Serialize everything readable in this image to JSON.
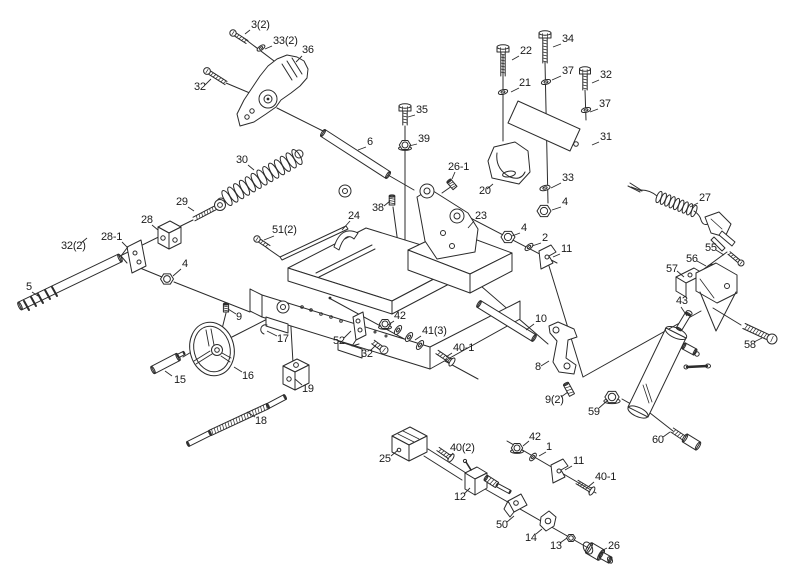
{
  "figure": {
    "type": "exploded-parts-diagram",
    "description": "Exploded assembly drawing of a machine (saw bed, handwheel, feed screw, hydraulic cylinder, switch and power cord) with numbered part callouts",
    "background": "#ffffff",
    "line_color": "#2b2b2b",
    "label_color": "#1a1a1a",
    "label_font_size": 11
  },
  "parts": [
    {
      "id": "3-2",
      "label": "3(2)",
      "x": 251,
      "y": 28,
      "leader": [
        [
          250,
          30
        ],
        [
          245,
          34
        ]
      ]
    },
    {
      "id": "33-2",
      "label": "33(2)",
      "x": 273,
      "y": 44,
      "leader": [
        [
          272,
          46
        ],
        [
          265,
          49
        ]
      ]
    },
    {
      "id": "36",
      "label": "36",
      "x": 302,
      "y": 53,
      "leader": [
        [
          302,
          56
        ],
        [
          296,
          62
        ]
      ]
    },
    {
      "id": "32-tl",
      "label": "32",
      "x": 194,
      "y": 90,
      "leader": [
        [
          205,
          85
        ],
        [
          211,
          79
        ]
      ]
    },
    {
      "id": "30",
      "label": "30",
      "x": 236,
      "y": 163,
      "leader": [
        [
          248,
          165
        ],
        [
          254,
          170
        ]
      ]
    },
    {
      "id": "29",
      "label": "29",
      "x": 176,
      "y": 205,
      "leader": [
        [
          188,
          207
        ],
        [
          194,
          211
        ]
      ]
    },
    {
      "id": "28",
      "label": "28",
      "x": 141,
      "y": 223,
      "leader": [
        [
          152,
          225
        ],
        [
          158,
          230
        ]
      ]
    },
    {
      "id": "28-1",
      "label": "28-1",
      "x": 101,
      "y": 240,
      "leader": [
        [
          122,
          242
        ],
        [
          128,
          248
        ]
      ]
    },
    {
      "id": "32-2",
      "label": "32(2)",
      "x": 61,
      "y": 249,
      "leader": [
        [
          81,
          243
        ],
        [
          87,
          238
        ]
      ]
    },
    {
      "id": "5",
      "label": "5",
      "x": 26,
      "y": 290,
      "leader": [
        [
          32,
          292
        ],
        [
          38,
          296
        ]
      ]
    },
    {
      "id": "4-left",
      "label": "4",
      "x": 182,
      "y": 267,
      "leader": [
        [
          181,
          269
        ],
        [
          173,
          276
        ]
      ]
    },
    {
      "id": "6",
      "label": "6",
      "x": 367,
      "y": 145,
      "leader": [
        [
          366,
          147
        ],
        [
          358,
          150
        ]
      ]
    },
    {
      "id": "35",
      "label": "35",
      "x": 416,
      "y": 113,
      "leader": [
        [
          415,
          115
        ],
        [
          408,
          117
        ]
      ]
    },
    {
      "id": "39",
      "label": "39",
      "x": 418,
      "y": 142,
      "leader": [
        [
          417,
          144
        ],
        [
          409,
          146
        ]
      ]
    },
    {
      "id": "26-1",
      "label": "26-1",
      "x": 448,
      "y": 170,
      "leader": [
        [
          455,
          172
        ],
        [
          452,
          179
        ]
      ]
    },
    {
      "id": "38",
      "label": "38",
      "x": 372,
      "y": 211,
      "leader": [
        [
          384,
          206
        ],
        [
          390,
          201
        ]
      ]
    },
    {
      "id": "24",
      "label": "24",
      "x": 348,
      "y": 219,
      "leader": [
        [
          350,
          221
        ],
        [
          342,
          230
        ]
      ]
    },
    {
      "id": "51-2",
      "label": "51(2)",
      "x": 272,
      "y": 233,
      "leader": [
        [
          274,
          236
        ],
        [
          264,
          240
        ]
      ]
    },
    {
      "id": "23",
      "label": "23",
      "x": 475,
      "y": 219,
      "leader": [
        [
          474,
          221
        ],
        [
          468,
          228
        ]
      ]
    },
    {
      "id": "22",
      "label": "22",
      "x": 520,
      "y": 54,
      "leader": [
        [
          519,
          56
        ],
        [
          512,
          60
        ]
      ]
    },
    {
      "id": "34",
      "label": "34",
      "x": 562,
      "y": 42,
      "leader": [
        [
          561,
          44
        ],
        [
          553,
          47
        ]
      ]
    },
    {
      "id": "21",
      "label": "21",
      "x": 519,
      "y": 86,
      "leader": [
        [
          519,
          88
        ],
        [
          511,
          92
        ]
      ]
    },
    {
      "id": "37-a",
      "label": "37",
      "x": 562,
      "y": 74,
      "leader": [
        [
          561,
          76
        ],
        [
          552,
          80
        ]
      ]
    },
    {
      "id": "32-r",
      "label": "32",
      "x": 600,
      "y": 78,
      "leader": [
        [
          599,
          80
        ],
        [
          592,
          83
        ]
      ]
    },
    {
      "id": "37-b",
      "label": "37",
      "x": 599,
      "y": 107,
      "leader": [
        [
          598,
          109
        ],
        [
          590,
          112
        ]
      ]
    },
    {
      "id": "31",
      "label": "31",
      "x": 600,
      "y": 140,
      "leader": [
        [
          599,
          142
        ],
        [
          592,
          145
        ]
      ]
    },
    {
      "id": "20",
      "label": "20",
      "x": 479,
      "y": 194,
      "leader": [
        [
          487,
          189
        ],
        [
          493,
          184
        ]
      ]
    },
    {
      "id": "33",
      "label": "33",
      "x": 562,
      "y": 181,
      "leader": [
        [
          561,
          183
        ],
        [
          551,
          188
        ]
      ]
    },
    {
      "id": "4-a",
      "label": "4",
      "x": 562,
      "y": 205,
      "leader": [
        [
          561,
          207
        ],
        [
          552,
          210
        ]
      ]
    },
    {
      "id": "4-b",
      "label": "4",
      "x": 521,
      "y": 231,
      "leader": [
        [
          520,
          233
        ],
        [
          512,
          236
        ]
      ]
    },
    {
      "id": "2",
      "label": "2",
      "x": 542,
      "y": 241,
      "leader": [
        [
          541,
          243
        ],
        [
          532,
          246
        ]
      ]
    },
    {
      "id": "11-mid",
      "label": "11",
      "x": 561,
      "y": 252,
      "leader": [
        [
          560,
          254
        ],
        [
          553,
          257
        ]
      ]
    },
    {
      "id": "27",
      "label": "27",
      "x": 699,
      "y": 201,
      "leader": [
        [
          698,
          203
        ],
        [
          690,
          207
        ]
      ]
    },
    {
      "id": "55",
      "label": "55",
      "x": 705,
      "y": 251,
      "leader": [
        [
          716,
          250
        ],
        [
          724,
          255
        ]
      ]
    },
    {
      "id": "56",
      "label": "56",
      "x": 686,
      "y": 262,
      "leader": [
        [
          697,
          261
        ],
        [
          706,
          266
        ]
      ]
    },
    {
      "id": "57",
      "label": "57",
      "x": 666,
      "y": 272,
      "leader": [
        [
          677,
          271
        ],
        [
          684,
          277
        ]
      ]
    },
    {
      "id": "43",
      "label": "43",
      "x": 676,
      "y": 304,
      "leader": [
        [
          681,
          307
        ],
        [
          687,
          316
        ]
      ]
    },
    {
      "id": "58",
      "label": "58",
      "x": 744,
      "y": 348,
      "leader": [
        [
          754,
          342
        ],
        [
          762,
          338
        ]
      ]
    },
    {
      "id": "59",
      "label": "59",
      "x": 588,
      "y": 415,
      "leader": [
        [
          599,
          408
        ],
        [
          608,
          400
        ]
      ]
    },
    {
      "id": "60",
      "label": "60",
      "x": 652,
      "y": 443,
      "leader": [
        [
          663,
          437
        ],
        [
          670,
          432
        ]
      ]
    },
    {
      "id": "9",
      "label": "9",
      "x": 236,
      "y": 320,
      "leader": [
        [
          236,
          314
        ],
        [
          228,
          309
        ]
      ]
    },
    {
      "id": "17",
      "label": "17",
      "x": 277,
      "y": 342,
      "leader": [
        [
          277,
          336
        ],
        [
          267,
          331
        ]
      ]
    },
    {
      "id": "16",
      "label": "16",
      "x": 242,
      "y": 379,
      "leader": [
        [
          242,
          372
        ],
        [
          234,
          367
        ]
      ]
    },
    {
      "id": "15",
      "label": "15",
      "x": 174,
      "y": 383,
      "leader": [
        [
          172,
          376
        ],
        [
          165,
          371
        ]
      ]
    },
    {
      "id": "19",
      "label": "19",
      "x": 302,
      "y": 392,
      "leader": [
        [
          302,
          385
        ],
        [
          295,
          379
        ]
      ]
    },
    {
      "id": "18",
      "label": "18",
      "x": 255,
      "y": 424,
      "leader": [
        [
          255,
          417
        ],
        [
          247,
          412
        ]
      ]
    },
    {
      "id": "25",
      "label": "25",
      "x": 379,
      "y": 462,
      "leader": [
        [
          391,
          456
        ],
        [
          398,
          450
        ]
      ]
    },
    {
      "id": "52",
      "label": "52",
      "x": 333,
      "y": 344,
      "leader": [
        [
          344,
          338
        ],
        [
          351,
          331
        ]
      ]
    },
    {
      "id": "32-b",
      "label": "32",
      "x": 361,
      "y": 357,
      "leader": [
        [
          371,
          350
        ],
        [
          376,
          345
        ]
      ]
    },
    {
      "id": "42-top",
      "label": "42",
      "x": 394,
      "y": 319,
      "leader": [
        [
          394,
          321
        ],
        [
          388,
          325
        ]
      ]
    },
    {
      "id": "41-3",
      "label": "41(3)",
      "x": 422,
      "y": 334,
      "leader": [
        [
          421,
          336
        ],
        [
          415,
          340
        ]
      ]
    },
    {
      "id": "40-1-a",
      "label": "40-1",
      "x": 453,
      "y": 351,
      "leader": [
        [
          452,
          353
        ],
        [
          446,
          357
        ]
      ]
    },
    {
      "id": "10",
      "label": "10",
      "x": 535,
      "y": 322,
      "leader": [
        [
          534,
          324
        ],
        [
          526,
          330
        ]
      ]
    },
    {
      "id": "8",
      "label": "8",
      "x": 535,
      "y": 370,
      "leader": [
        [
          541,
          366
        ],
        [
          549,
          361
        ]
      ]
    },
    {
      "id": "9-2",
      "label": "9(2)",
      "x": 545,
      "y": 403,
      "leader": [
        [
          561,
          397
        ],
        [
          568,
          392
        ]
      ]
    },
    {
      "id": "40-2",
      "label": "40(2)",
      "x": 450,
      "y": 451,
      "leader": [
        [
          453,
          453
        ],
        [
          450,
          457
        ]
      ]
    },
    {
      "id": "42-bot",
      "label": "42",
      "x": 529,
      "y": 440,
      "leader": [
        [
          529,
          441
        ],
        [
          523,
          446
        ]
      ]
    },
    {
      "id": "1",
      "label": "1",
      "x": 546,
      "y": 450,
      "leader": [
        [
          546,
          452
        ],
        [
          539,
          456
        ]
      ]
    },
    {
      "id": "11-bot",
      "label": "11",
      "x": 573,
      "y": 464,
      "leader": [
        [
          572,
          466
        ],
        [
          565,
          470
        ]
      ]
    },
    {
      "id": "40-1-b",
      "label": "40-1",
      "x": 595,
      "y": 480,
      "leader": [
        [
          594,
          482
        ],
        [
          588,
          487
        ]
      ]
    },
    {
      "id": "12",
      "label": "12",
      "x": 454,
      "y": 500,
      "leader": [
        [
          464,
          494
        ],
        [
          470,
          488
        ]
      ]
    },
    {
      "id": "50",
      "label": "50",
      "x": 496,
      "y": 528,
      "leader": [
        [
          507,
          522
        ],
        [
          514,
          516
        ]
      ]
    },
    {
      "id": "14",
      "label": "14",
      "x": 525,
      "y": 541,
      "leader": [
        [
          536,
          534
        ],
        [
          542,
          529
        ]
      ]
    },
    {
      "id": "13",
      "label": "13",
      "x": 550,
      "y": 549,
      "leader": [
        [
          560,
          543
        ],
        [
          567,
          538
        ]
      ]
    },
    {
      "id": "26-knob",
      "label": "26",
      "x": 608,
      "y": 549,
      "leader": [
        [
          607,
          548
        ],
        [
          601,
          551
        ]
      ]
    }
  ]
}
